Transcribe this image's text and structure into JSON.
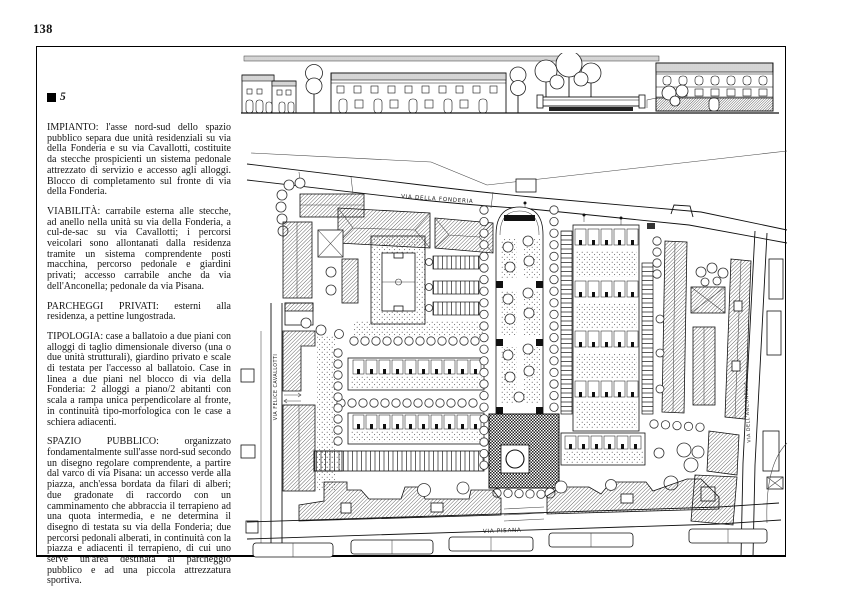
{
  "page": {
    "number": "138",
    "section_marker": "5"
  },
  "article": {
    "paragraphs": [
      "IMPIANTO: l'asse nord-sud dello spazio pubblico separa due unità residenziali su via della Fonderia e su via Cavallotti, costituite da stecche prospicienti un sistema pedonale attrezzato di servizio e accesso agli alloggi. Blocco di completamento sul fronte di via della Fonderia.",
      "VIABILITÀ: carrabile esterna alle stecche, ad anello nella unità su via della Fonderia, a cul-de-sac su via Cavallotti; i percorsi veicolari sono allontanati dalla residenza tramite un sistema comprendente posti macchina, percorso pedonale e giardini privati; accesso carrabile anche da via dell'Anconella; pedonale da via Pisana.",
      "PARCHEGGI PRIVATI: esterni alla residenza, a pettine lungostrada.",
      "TIPOLOGIA: case a ballatoio a due piani con alloggi di taglio dimensionale diverso (una o due unità strutturali), giardino privato e scale di testata per l'accesso al ballatoio. Case in linea a due piani nel blocco di via della Fonderia: 2 alloggi a piano/2 abitanti con scala a rampa unica perpendicolare al fronte, in continuità tipo-morfologica con le case a schiera adiacenti.",
      "SPAZIO PUBBLICO: organizzato fondamentalmente sull'asse nord-sud secondo un disegno regolare comprendente, a partire dal varco di via Pisana: un accesso verde alla piazza, anch'essa bordata da filari di alberi; due gradonate di raccordo con un camminamento che abbraccia il terrapieno ad una quota intermedia, e ne determina il disegno di testata su via della Fonderia; due percorsi pedonali alberati, in continuità con la piazza e adiacenti il terrapieno, di cui uno serve un'area destinata al parcheggio pubblico e ad una piccola attrezzatura sportiva."
    ]
  },
  "plan": {
    "street_labels": {
      "fonderia": "VIA DELLA FONDERIA",
      "cavallotti": "VIA FELICE CAVALLOTTI",
      "anconella": "VIA DELL'ANCONELLA",
      "pisana": "VIA PISANA"
    },
    "ink_color": "#111111",
    "paper_color": "#ffffff"
  }
}
